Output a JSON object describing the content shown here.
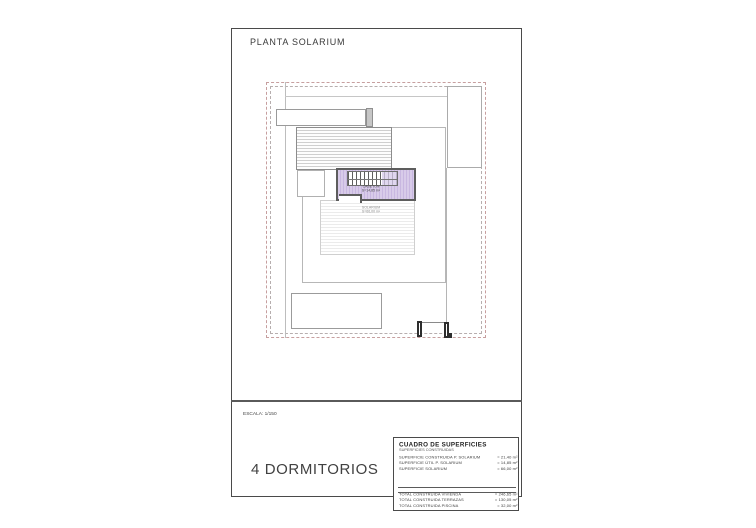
{
  "header": {
    "title": "PLANTA SOLARIUM"
  },
  "plan": {
    "stair_room_label": {
      "line1": "CASETON",
      "line2": "S=14,85 m²"
    },
    "solarium_label": {
      "line1": "SOLARIUM",
      "line2": "S=66,00 m²"
    },
    "colors": {
      "highlight_fill": "#d8cbe9",
      "highlight_hatch": "#c8b7e0",
      "boundary_dash": "#c79f9f",
      "wall_dark": "#5d5d5d"
    }
  },
  "title_block": {
    "scale": "ESCALA: 1/150",
    "bedrooms": "4 DORMITORIOS"
  },
  "surfaces_table": {
    "title": "CUADRO DE SUPERFICIES",
    "subtitle": "SUPERFICIES CONSTRUIDAS",
    "rows": [
      {
        "label": "SUPERFICIE CONSTRUIDA P. SOLARIUM",
        "value": "= 21,40 m²"
      },
      {
        "label": "SUPERFICIE ÚTIL P. SOLARIUM",
        "value": "= 14,85 m²"
      },
      {
        "label": "SUPERFICIE SOLARIUM",
        "value": "= 66,00 m²"
      },
      {
        "label": "TOTAL CONSTRUIDA VIVIENDA",
        "value": "= 246,65 m²"
      },
      {
        "label": "TOTAL CONSTRUIDA TERRAZAS",
        "value": "= 130,05 m²"
      },
      {
        "label": "TOTAL CONSTRUIDA PISCINA",
        "value": "= 32,00 m²"
      }
    ]
  }
}
